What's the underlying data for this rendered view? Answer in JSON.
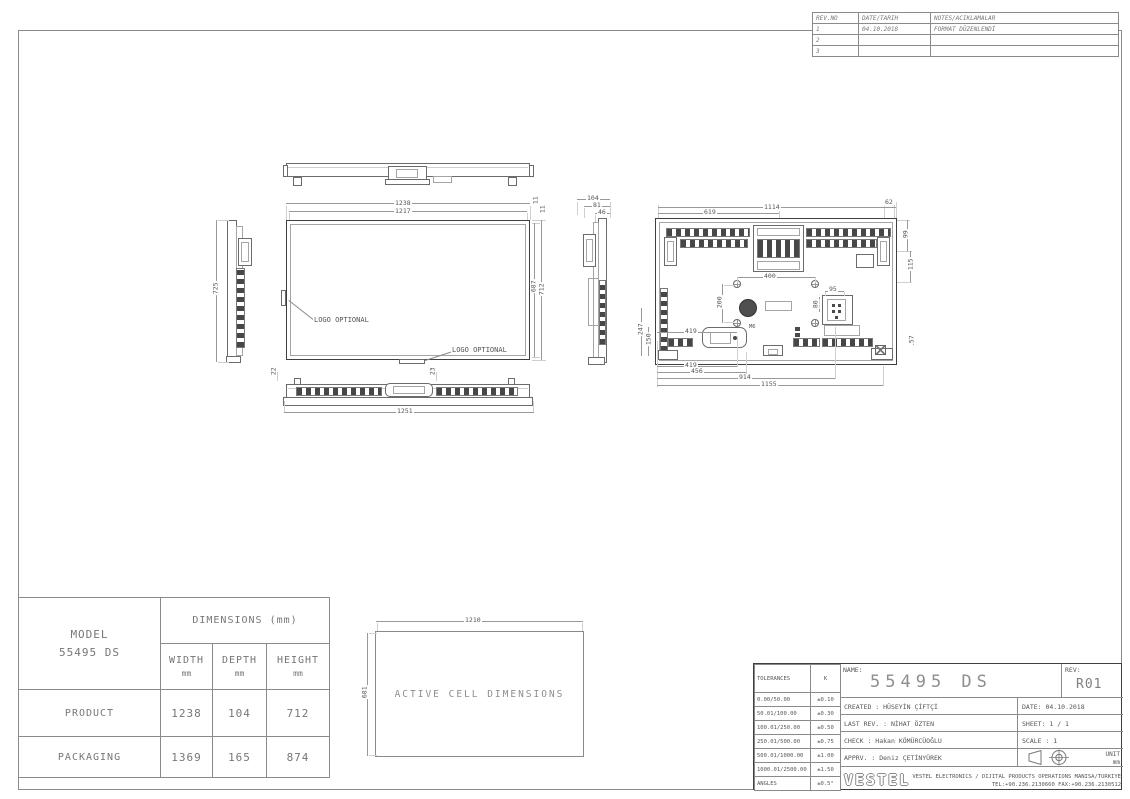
{
  "revision_table": {
    "headers": {
      "no": "REV.NO",
      "date": "DATE/TARIH",
      "notes": "NOTES/ACIKLAMALAR"
    },
    "rows": [
      {
        "no": "1",
        "date": "04.10.2018",
        "note": "FORMAT DÜZENLENDİ"
      },
      {
        "no": "2",
        "date": "",
        "note": ""
      },
      {
        "no": "3",
        "date": "",
        "note": ""
      }
    ]
  },
  "front_view": {
    "dim_width_outer": "1238",
    "dim_width_inner": "1217",
    "dim_bezel_top": "11",
    "dim_bezel_right": "11",
    "dim_height_inner": "687",
    "dim_height_outer": "712",
    "logo_label_left": "LOGO OPTIONAL",
    "logo_label_bottom": "LOGO OPTIONAL"
  },
  "left_view": {
    "dim_height": "725"
  },
  "right_view": {
    "dim_depth_full": "104",
    "dim_depth_mid": "81",
    "dim_depth_body": "46"
  },
  "rear_view": {
    "dim_top_full": "1114",
    "dim_top_left": "619",
    "dim_top_right": "62",
    "dim_right_upper": "99",
    "dim_right_lower": "115",
    "dim_vesa_width": "400",
    "dim_vesa_height": "200",
    "dim_left_upper": "247",
    "dim_left_lower": "150",
    "dim_socket_width": "95",
    "dim_socket_height": "80",
    "dim_handle": "419",
    "thread_label": "M6",
    "dim_bottom_1": "419",
    "dim_bottom_2": "456",
    "dim_bottom_3": "914",
    "dim_bottom_4": "1155",
    "dim_corner": "57"
  },
  "bottom_view": {
    "dim_width": "1251",
    "dim_offset_left": "22",
    "dim_offset_center": "23"
  },
  "active_cell": {
    "label": "ACTIVE CELL DIMENSIONS",
    "dim_width": "1210",
    "dim_height": "681"
  },
  "model_table": {
    "model_label": "MODEL",
    "model_value": "55495 DS",
    "dims_header": "DIMENSIONS (mm)",
    "columns": [
      {
        "label": "WIDTH",
        "unit": "mm"
      },
      {
        "label": "DEPTH",
        "unit": "mm"
      },
      {
        "label": "HEIGHT",
        "unit": "mm"
      }
    ],
    "rows": [
      {
        "label": "PRODUCT",
        "width": "1238",
        "depth": "104",
        "height": "712"
      },
      {
        "label": "PACKAGING",
        "width": "1369",
        "depth": "165",
        "height": "874"
      }
    ]
  },
  "tolerance_table": {
    "header_left": "TOLERANCES",
    "header_right": "K",
    "rows": [
      {
        "range": "0.00/50.00",
        "tol": "±0.10"
      },
      {
        "range": "50.01/100.00",
        "tol": "±0.30"
      },
      {
        "range": "100.01/250.00",
        "tol": "±0.50"
      },
      {
        "range": "250.01/500.00",
        "tol": "±0.75"
      },
      {
        "range": "500.01/1000.00",
        "tol": "±1.00"
      },
      {
        "range": "1000.01/2500.00",
        "tol": "±1.50"
      },
      {
        "range": "ANGLES",
        "tol": "±0.5°"
      }
    ]
  },
  "title_block": {
    "name_label": "NAME:",
    "name_value": "55495 DS",
    "rev_label": "REV:",
    "rev_value": "R01",
    "created": "CREATED : HÜSEYİN ÇİFTÇİ",
    "last_rev": "LAST REV. : NİHAT ÖZTEN",
    "check": "CHECK : Hakan KÖMÜRCÜOĞLU",
    "apprv": "APPRV. : Deniz ÇETİNYÜREK",
    "date": "DATE: 04.10.2018",
    "sheet": "SHEET: 1 / 1",
    "scale": "SCALE : 1",
    "unit_label": "UNIT",
    "unit_value": "mm",
    "logo": "VESTEL",
    "company_line1": "VESTEL ELECTRONICS / DIJITAL PRODUCTS OPERATIONS MANISA/TURKIYE",
    "company_line2": "TEL:+90.236.2130660 FAX:+90.236.2130512"
  }
}
